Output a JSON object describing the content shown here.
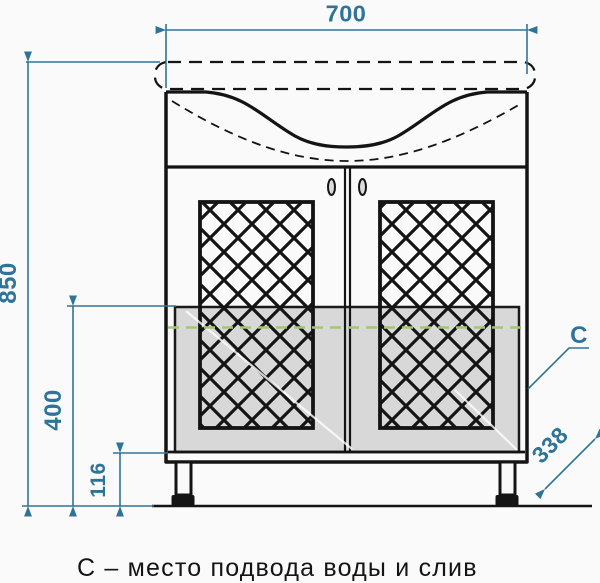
{
  "drawing": {
    "caption": "С – место подвода воды и слив",
    "connection_label": "С",
    "dimensions": {
      "overall_width_mm": "700",
      "overall_height_mm": "850",
      "connection_zone_height_mm": "400",
      "leg_clearance_mm": "116",
      "depth_mm": "338"
    },
    "colors": {
      "dimension_blue": "#2e7499",
      "line_black": "#141414",
      "connection_green": "#a5c476",
      "glass_gray": "#d8d8d8"
    }
  }
}
